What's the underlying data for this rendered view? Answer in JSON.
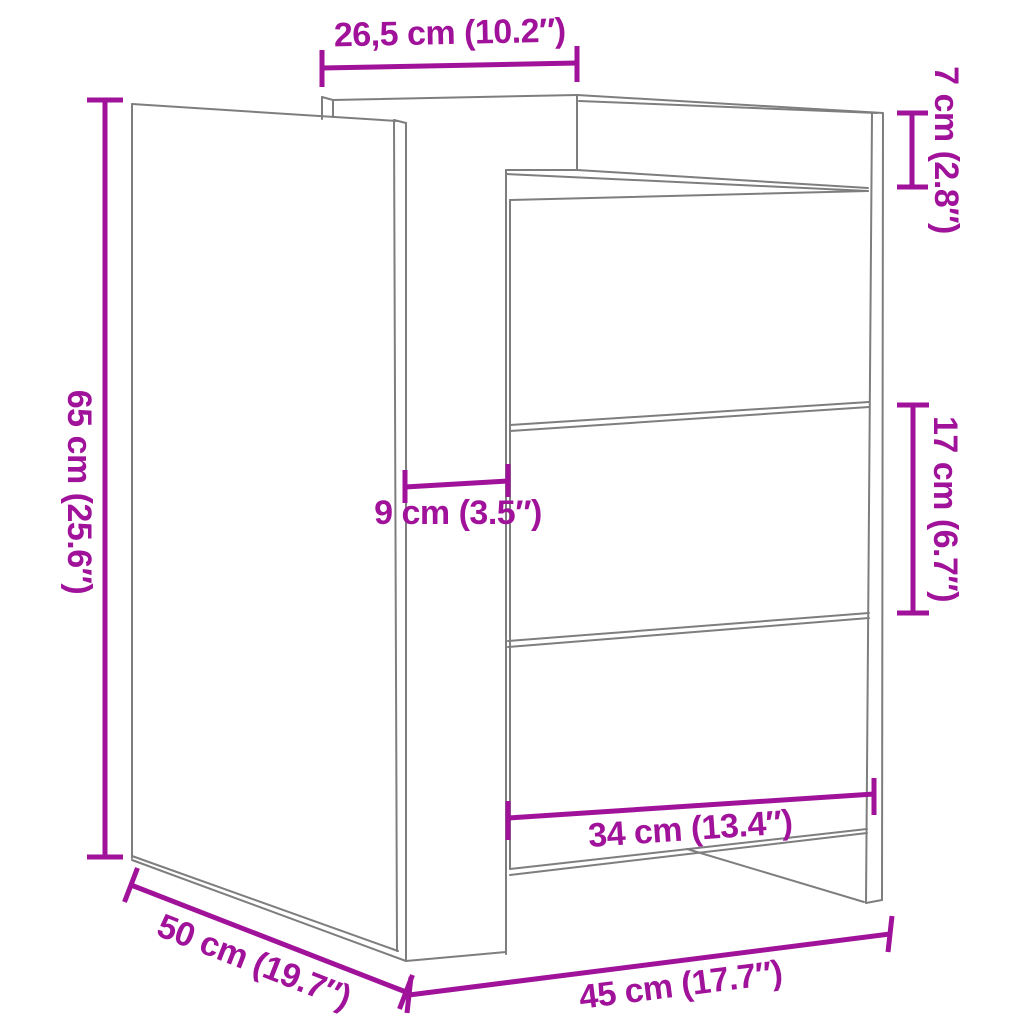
{
  "diagram": {
    "subject": "three-drawer bedside cabinet line drawing with measurements",
    "background_color": "#FFFFFF",
    "line_color": "#7E7E7E",
    "dimension_color": "#A0129A",
    "dimensions": {
      "top_depth": {
        "label": "26,5 cm (10.2″)",
        "orientation": "horizontal-top"
      },
      "top_section_height": {
        "label": "7 cm (2.8″)",
        "orientation": "vertical-right"
      },
      "total_height": {
        "label": "65 cm (25.6″)",
        "orientation": "vertical-left"
      },
      "side_overhang": {
        "label": "9 cm (3.5″)",
        "orientation": "horizontal-middle"
      },
      "drawer_height": {
        "label": "17 cm (6.7″)",
        "orientation": "vertical-right"
      },
      "drawer_width": {
        "label": "34 cm (13.4″)",
        "orientation": "slanted-bottom-front"
      },
      "depth": {
        "label": "50 cm (19.7″)",
        "orientation": "slanted-bottom-left"
      },
      "width": {
        "label": "45 cm (17.7″)",
        "orientation": "slanted-bottom"
      }
    }
  }
}
